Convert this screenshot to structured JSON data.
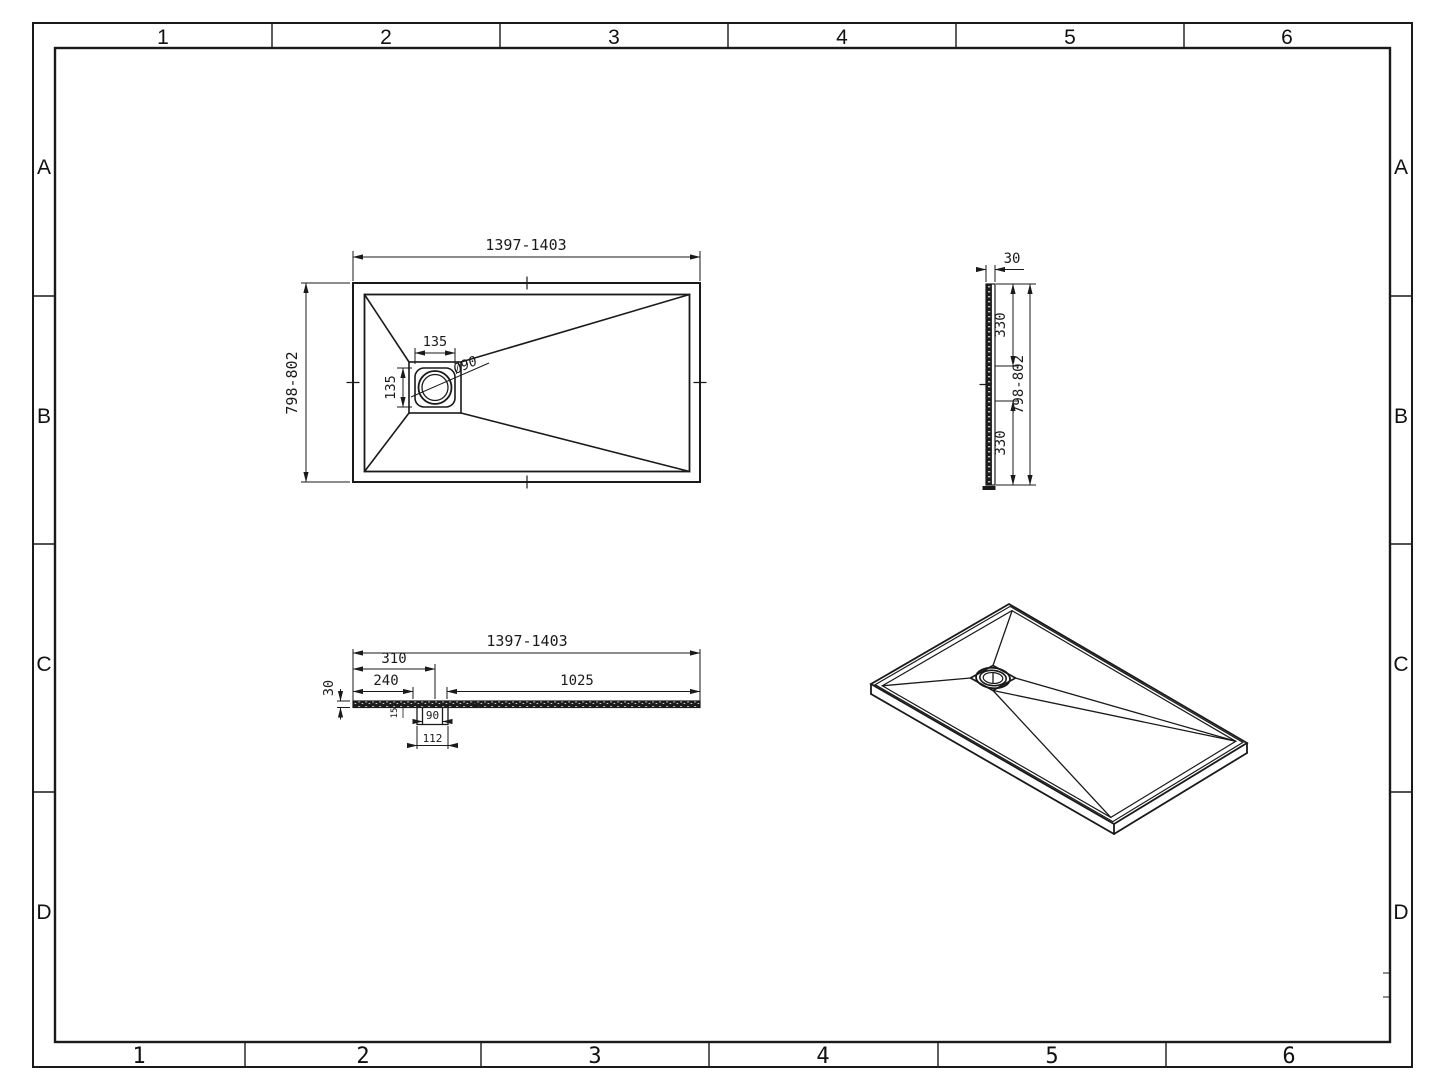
{
  "colors": {
    "line": "#1a1a1a",
    "background": "#ffffff"
  },
  "frame": {
    "top_labels": [
      "1",
      "2",
      "3",
      "4",
      "5",
      "6"
    ],
    "bottom_labels": [
      "1",
      "2",
      "3",
      "4",
      "5",
      "6"
    ],
    "left_labels": [
      "A",
      "B",
      "C",
      "D"
    ],
    "right_labels": [
      "A",
      "B",
      "C",
      "D"
    ]
  },
  "plan_view": {
    "overall_width": "1397-1403",
    "overall_depth": "798-802",
    "drain_width": "135",
    "drain_depth": "135",
    "drain_diameter": "Ø90"
  },
  "side_view": {
    "thickness": "30",
    "drain_offset_top": "330",
    "drain_offset_bottom": "330",
    "overall_depth": "798-802"
  },
  "section_view": {
    "overall_width": "1397-1403",
    "drain_center_offset": "310",
    "drain_edge_offset": "240",
    "drain_to_end": "1025",
    "thickness": "30",
    "recess_depth": "15",
    "drain_throat": "90",
    "drain_flange": "112"
  }
}
